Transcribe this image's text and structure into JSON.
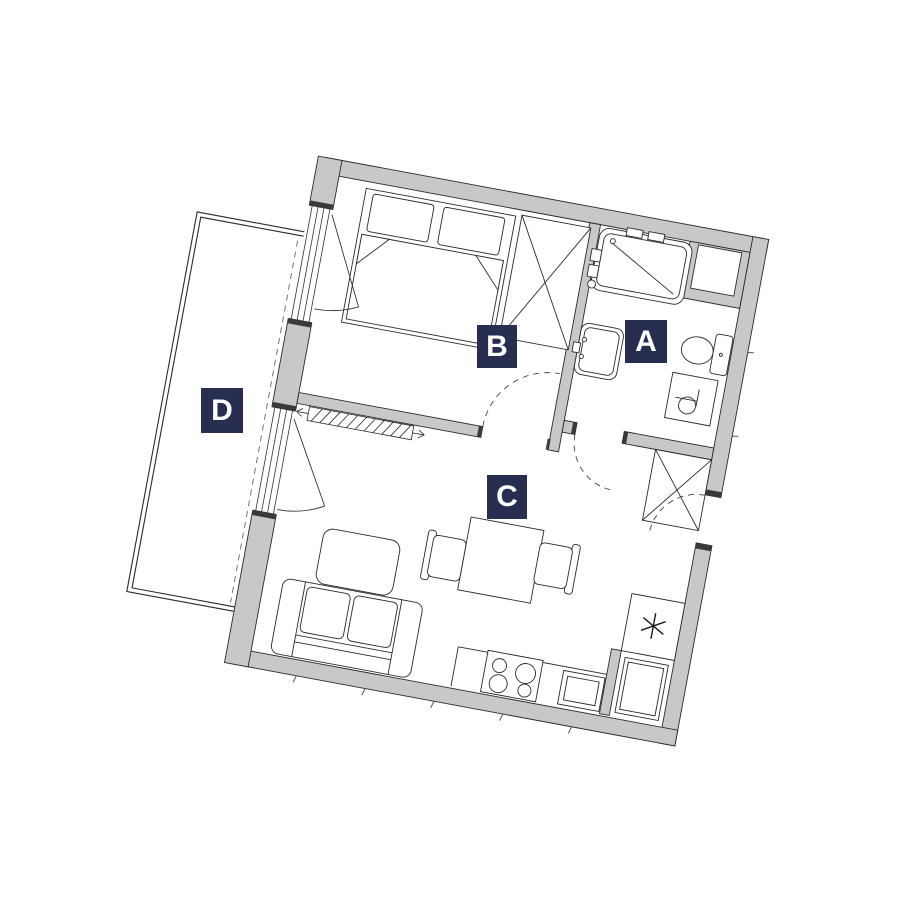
{
  "plan": {
    "type": "apartment-floor-plan",
    "rotation_deg": 10.5,
    "colors": {
      "background": "#ffffff",
      "wall_fill": "#c8c8c8",
      "line": "#222222",
      "label_bg": "#272e50",
      "label_text": "#ffffff"
    },
    "rooms": {
      "A": {
        "label": "A",
        "name": "bathroom"
      },
      "B": {
        "label": "B",
        "name": "bedroom"
      },
      "C": {
        "label": "C",
        "name": "living-room-kitchen"
      },
      "D": {
        "label": "D",
        "name": "balcony"
      }
    },
    "fixtures": [
      "double-bed",
      "wardrobe",
      "bathtub",
      "bathroom-sink",
      "toilet",
      "washing-machine",
      "duct-shaft",
      "hall-closet",
      "radiator",
      "sofa",
      "coffee-table",
      "dining-table",
      "dining-chairs",
      "kitchen-counter",
      "hob",
      "kitchen-sink",
      "boiler-star",
      "fridge",
      "balcony-railing",
      "entrance-door",
      "door-swing-arcs",
      "balcony-doors"
    ]
  }
}
